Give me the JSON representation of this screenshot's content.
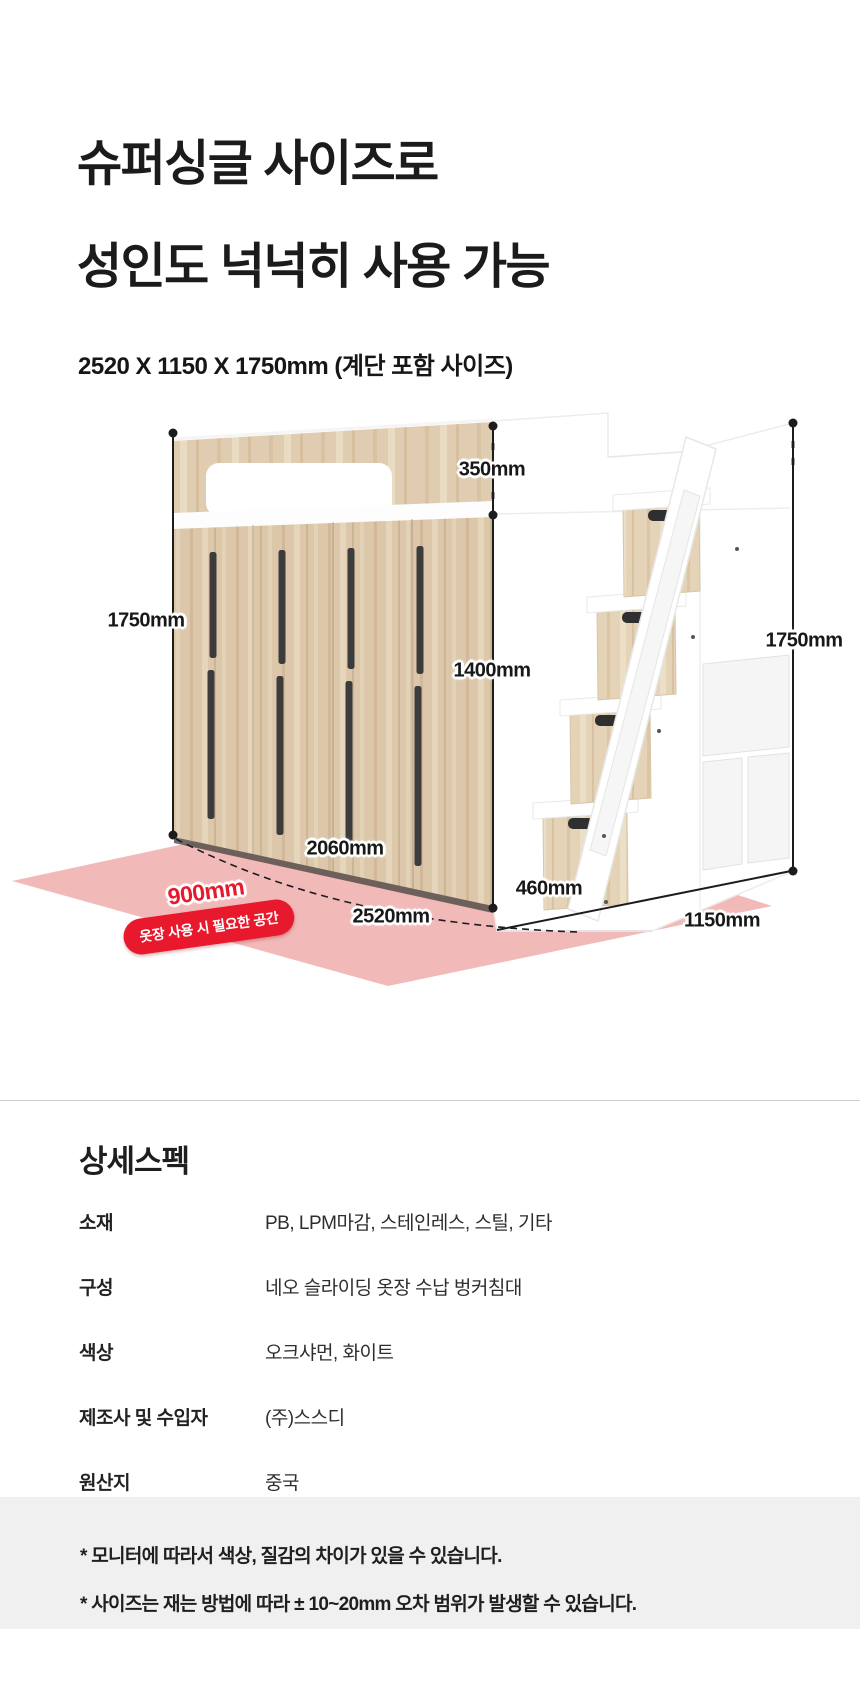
{
  "title": {
    "line1": "슈퍼싱글 사이즈로",
    "line2": "성인도 넉넉히 사용 가능",
    "subtitle": "2520 X 1150 X 1750mm (계단 포함 사이즈)"
  },
  "diagram": {
    "dim_left_height": "1750mm",
    "dim_headboard_height": "350mm",
    "dim_under_bed_height": "1400mm",
    "dim_right_height": "1750mm",
    "dim_wardrobe_width": "2060mm",
    "dim_total_width": "2520mm",
    "dim_stair_depth": "460mm",
    "dim_side_depth": "1150mm",
    "dim_clearance": "900mm",
    "clearance_badge": "옷장 사용 시 필요한 공간",
    "colors": {
      "accent_red": "#e8192d",
      "floor_pink": "#f2b9b9",
      "oak": "#dcc7aa",
      "furniture_white": "#ffffff"
    }
  },
  "specs": {
    "heading": "상세스펙",
    "rows": [
      {
        "label": "소재",
        "value": "PB, LPM마감, 스테인레스, 스틸, 기타"
      },
      {
        "label": "구성",
        "value": "네오 슬라이딩 옷장 수납 벙커침대"
      },
      {
        "label": "색상",
        "value": "오크샤먼, 화이트"
      },
      {
        "label": "제조사 및 수입자",
        "value": "(주)스스디"
      },
      {
        "label": "원산지",
        "value": "중국"
      }
    ]
  },
  "footnotes": {
    "notes": [
      "* 모니터에 따라서 색상, 질감의 차이가 있을 수 있습니다.",
      "* 사이즈는 재는 방법에 따라 ± 10~20mm 오차 범위가 발생할 수 있습니다."
    ]
  }
}
